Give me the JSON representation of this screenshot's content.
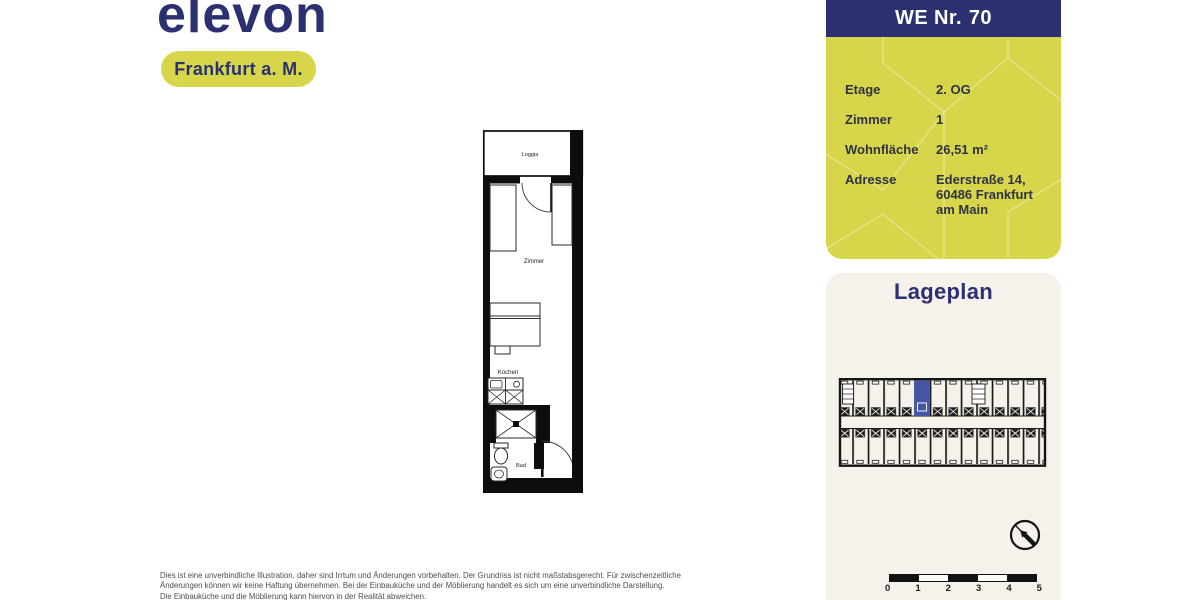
{
  "brand": {
    "logo": "elevon",
    "badge": "Frankfurt a. M."
  },
  "unit_panel": {
    "title_prefix": "WE Nr.",
    "title_number": "70",
    "rows": [
      {
        "label": "Etage",
        "value": "2. OG"
      },
      {
        "label": "Zimmer",
        "value": "1"
      },
      {
        "label": "Wohnfläche",
        "value": "26,51 m²"
      },
      {
        "label": "Adresse",
        "value_lines": [
          "Ederstraße 14,",
          "60486 Frankfurt",
          "am Main"
        ]
      }
    ]
  },
  "floorplan": {
    "labels": {
      "loggia": "Loggia",
      "zimmer": "Zimmer",
      "kochen": "Kochen",
      "bad": "Bad"
    }
  },
  "lageplan": {
    "title": "Lageplan",
    "scale_labels": [
      "0",
      "1",
      "2",
      "3",
      "4",
      "5"
    ]
  },
  "disclaimer": {
    "line1": "Dies ist eine unverbindliche Illustration, daher sind Irrtum und Änderungen vorbehalten. Der Grundriss ist nicht maßstabsgerecht. Für zwischenzeitliche",
    "line2": "Änderungen können wir keine Haftung übernehmen. Bei der Einbauküche und der Möblierung handelt es sich um eine unverbindliche Darstellung.",
    "line3": "Die Einbauküche und die Möblierung kann hiervon in der Realität abweichen."
  },
  "colors": {
    "navy": "#2b3170",
    "yellow": "#d7d64b",
    "cream": "#f6f1ea",
    "highlight_blue": "#4556a6"
  }
}
